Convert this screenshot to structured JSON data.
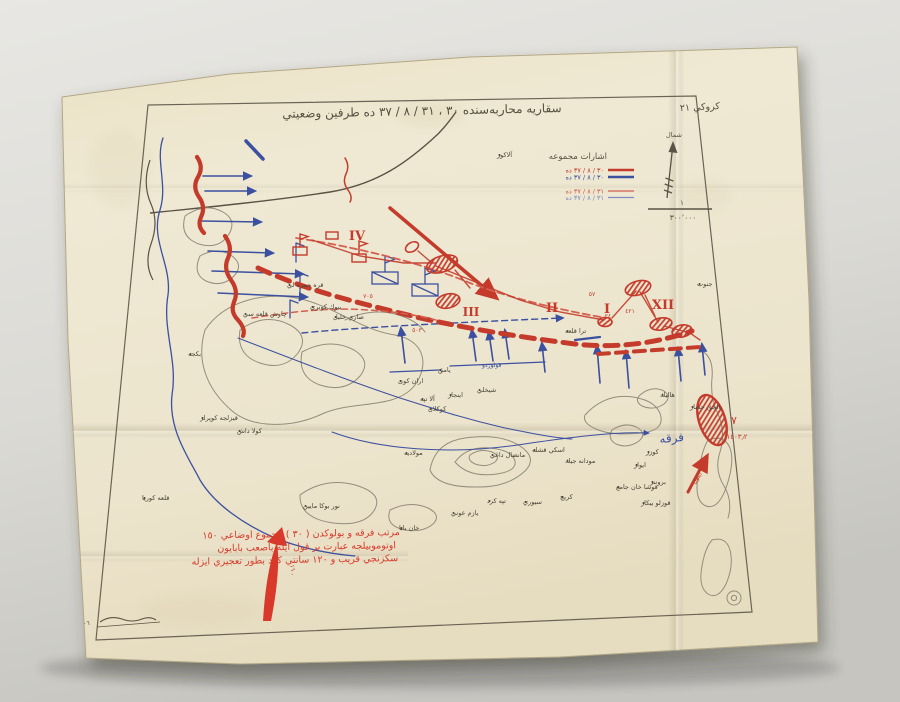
{
  "photo": {
    "surface_color": "#dddcd7",
    "paper_color": "#ece4cb",
    "shadow_color": "#3b372c"
  },
  "map": {
    "sheet_label": "كروكي ٢١",
    "title": "سقاريه محاربه‌سنده ٣٠ ، ٣١ / ٨ / ٣٧ ده طرفين وضعيتي",
    "compass_label": "شمال",
    "scale": {
      "numerator": "١",
      "denominator": "٣٠٠٬٠٠٠"
    },
    "legend": {
      "title": "اشارات مجموعه",
      "entries": [
        {
          "label": "٣٠ / ٨ / ٣٧ ده",
          "style": "solid-thick",
          "color": "#c43b2c"
        },
        {
          "label": "٣٠ / ٨ / ٣٧ ده",
          "style": "solid-thick",
          "color": "#3c50a0"
        },
        {
          "label": "٣١ / ٨ / ٣٧ ده",
          "style": "solid-thin",
          "color": "#d4604f"
        },
        {
          "label": "٣١ / ٨ / ٣٧ ده",
          "style": "solid-thin",
          "color": "#7c8cc4"
        }
      ]
    },
    "roman_numerals": [
      {
        "text": "IV",
        "x": 357,
        "y": 240,
        "s": 13
      },
      {
        "text": "III",
        "x": 471,
        "y": 316,
        "s": 12
      },
      {
        "text": "II",
        "x": 552,
        "y": 312,
        "s": 13
      },
      {
        "text": "I",
        "x": 607,
        "y": 313,
        "s": 13
      },
      {
        "text": "XII",
        "x": 663,
        "y": 309,
        "s": 13
      }
    ],
    "red_numbers": [
      {
        "text": "٧٠٥",
        "x": 368,
        "y": 298,
        "s": 6,
        "r": 0
      },
      {
        "text": "٥٠٣",
        "x": 417,
        "y": 332,
        "s": 6,
        "r": 0
      },
      {
        "text": "٥٧",
        "x": 592,
        "y": 296,
        "s": 6,
        "r": 0
      },
      {
        "text": "٢٤",
        "x": 608,
        "y": 318,
        "s": 6,
        "r": 0
      },
      {
        "text": "٤٢١",
        "x": 630,
        "y": 313,
        "s": 6,
        "r": 0
      },
      {
        "text": "٧",
        "x": 734,
        "y": 424,
        "s": 11,
        "r": 0
      },
      {
        "text": "١٤٠٣٫٢",
        "x": 737,
        "y": 439,
        "s": 7,
        "r": 0
      },
      {
        "text": "٤ ايلول",
        "x": 700,
        "y": 477,
        "s": 6,
        "r": -55
      }
    ],
    "places": [
      {
        "name": "آلاكوز",
        "x": 497,
        "y": 157
      },
      {
        "name": "جنوب",
        "x": 697,
        "y": 286
      },
      {
        "name": "قره حمزه لي",
        "x": 287,
        "y": 287
      },
      {
        "name": "بيوك كوپري",
        "x": 310,
        "y": 309
      },
      {
        "name": "صاري خليل",
        "x": 333,
        "y": 319
      },
      {
        "name": "چاوش قلعه سي",
        "x": 243,
        "y": 316
      },
      {
        "name": "بكجه",
        "x": 188,
        "y": 356
      },
      {
        "name": "قيزلجه كوپرلر",
        "x": 200,
        "y": 420
      },
      {
        "name": "كولا داش",
        "x": 237,
        "y": 433
      },
      {
        "name": "قلعه كوريا",
        "x": 142,
        "y": 500
      },
      {
        "name": "اران كوى",
        "x": 398,
        "y": 383
      },
      {
        "name": "يامق",
        "x": 438,
        "y": 372
      },
      {
        "name": "شيخلي",
        "x": 477,
        "y": 392
      },
      {
        "name": "اينجاز",
        "x": 448,
        "y": 397
      },
      {
        "name": "آلا تپه",
        "x": 420,
        "y": 401
      },
      {
        "name": "كوكلان",
        "x": 428,
        "y": 411
      },
      {
        "name": "مولاديه",
        "x": 404,
        "y": 455
      },
      {
        "name": "مانضال داغي",
        "x": 490,
        "y": 457
      },
      {
        "name": "اسكي قشله",
        "x": 532,
        "y": 452
      },
      {
        "name": "مودانه جيك",
        "x": 565,
        "y": 463
      },
      {
        "name": "قوشا خان جامع",
        "x": 616,
        "y": 489
      },
      {
        "name": "كريچ",
        "x": 560,
        "y": 499
      },
      {
        "name": "سيوري",
        "x": 523,
        "y": 504
      },
      {
        "name": "تپه كرد",
        "x": 487,
        "y": 503
      },
      {
        "name": "يازم عوني",
        "x": 451,
        "y": 515
      },
      {
        "name": "خان بابا",
        "x": 399,
        "y": 530
      },
      {
        "name": "نور بوكا مايين",
        "x": 303,
        "y": 508
      },
      {
        "name": "هاليك",
        "x": 660,
        "y": 397
      },
      {
        "name": "بالجق حصار",
        "x": 690,
        "y": 409
      },
      {
        "name": "كوزر",
        "x": 646,
        "y": 454
      },
      {
        "name": "ايواز",
        "x": 634,
        "y": 467
      },
      {
        "name": "بروننر",
        "x": 650,
        "y": 484
      },
      {
        "name": "قوزلو بيكار",
        "x": 641,
        "y": 505
      },
      {
        "name": "ترا قلعه",
        "x": 565,
        "y": 333
      }
    ],
    "note_lines": [
      "مرتب فرقه و بولوكدن ( ٣٠ ) مجموع اوضاعي ١٥٠",
      "اوتوموبيلجه عبارت بر قول ايله باصعب بابايون",
      "سكزنجي قريب و ١٢٠ سانتي كرد بطور تعجيري ايزله"
    ],
    "division_label": "فرقه",
    "corps_label": "قولوردو",
    "signature": "٧٠٦",
    "colors": {
      "red": "#c43b2c",
      "red_light": "#d4604f",
      "blue": "#3c50a0",
      "blue_light": "#7c8cc4",
      "ink": "#5a5244",
      "contour": "#938d7d",
      "note_red": "#d8392b"
    }
  }
}
